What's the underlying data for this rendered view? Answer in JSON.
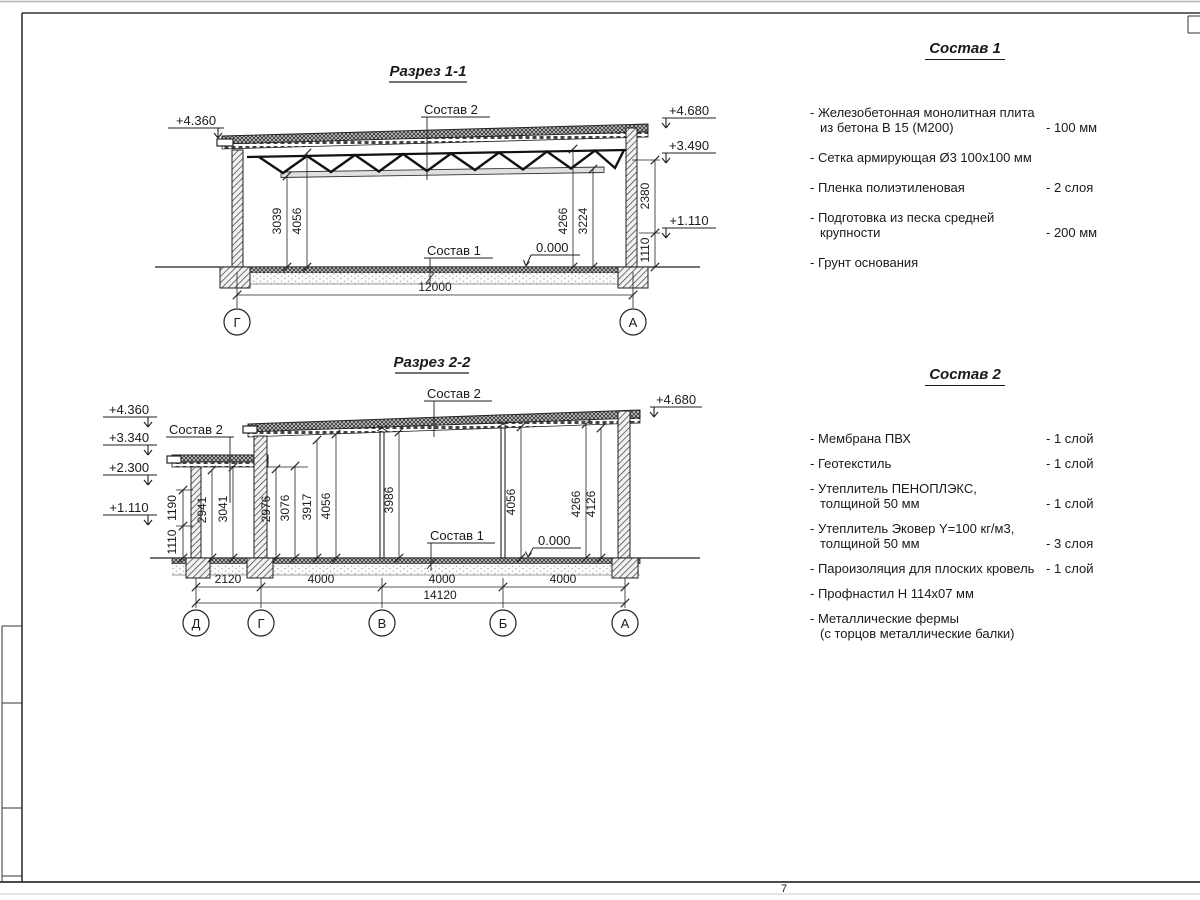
{
  "sheet": {
    "page_number": "7"
  },
  "section1": {
    "title": "Разрез 1-1",
    "sostav2_label": "Состав 2",
    "sostav1_label": "Состав 1",
    "zero_label": "0.000",
    "elev_left": "+4.360",
    "elev_right": [
      "+4.680",
      "+3.490",
      "+1.110"
    ],
    "dims_right": [
      "2380",
      "1110"
    ],
    "dims_height": [
      "3039",
      "4056",
      "4266",
      "3224"
    ],
    "dim_span": "12000",
    "grid_left": "Г",
    "grid_right": "А"
  },
  "section2": {
    "title": "Разрез 2-2",
    "sostav2_label_annex": "Состав 2",
    "sostav2_label_main": "Состав 2",
    "sostav1_label": "Состав 1",
    "zero_label": "0.000",
    "elev_left": [
      "+4.360",
      "+3.340",
      "+2.300",
      "+1.110"
    ],
    "elev_right": "+4.680",
    "dims_left": [
      "1190",
      "1110"
    ],
    "dims_height": [
      "2941",
      "3041",
      "2976",
      "3076",
      "3917",
      "4056",
      "3986",
      "4056",
      "4266",
      "4126"
    ],
    "dims_span": [
      "2120",
      "4000",
      "4000",
      "4000"
    ],
    "dim_total": "14120",
    "grid": [
      "Д",
      "Г",
      "В",
      "Б",
      "А"
    ]
  },
  "sostav1": {
    "title": "Состав 1",
    "items": [
      {
        "l1": "- Железобетонная  монолитная плита",
        "l2": "из бетона В 15 (М200)",
        "val": "- 100 мм"
      },
      {
        "l1": "- Сетка армирующая Ø3 100х100 мм",
        "l2": "",
        "val": ""
      },
      {
        "l1": "- Пленка полиэтиленовая",
        "l2": "",
        "val": "-  2 слоя"
      },
      {
        "l1": "- Подготовка из песка средней",
        "l2": "крупности",
        "val": "- 200 мм"
      },
      {
        "l1": "- Грунт основания",
        "l2": "",
        "val": ""
      }
    ]
  },
  "sostav2": {
    "title": "Состав 2",
    "items": [
      {
        "l1": "- Мембрана ПВХ",
        "l2": "",
        "val": "- 1 слой"
      },
      {
        "l1": "- Геотекстиль",
        "l2": "",
        "val": "- 1 слой"
      },
      {
        "l1": "- Утеплитель ПЕНОПЛЭКС,",
        "l2": "толщиной 50 мм",
        "val": "- 1 слой"
      },
      {
        "l1": "- Утеплитель Эковер Y=100 кг/м3,",
        "l2": "толщиной 50 мм",
        "val": "- 3 слоя"
      },
      {
        "l1": "- Пароизоляция для плоских кровель",
        "l2": "",
        "val": "- 1 слой"
      },
      {
        "l1": "- Профнастил Н 114х07 мм",
        "l2": "",
        "val": ""
      },
      {
        "l1": "- Металлические фермы",
        "l2": "(с торцов металлические балки)",
        "val": ""
      }
    ]
  }
}
